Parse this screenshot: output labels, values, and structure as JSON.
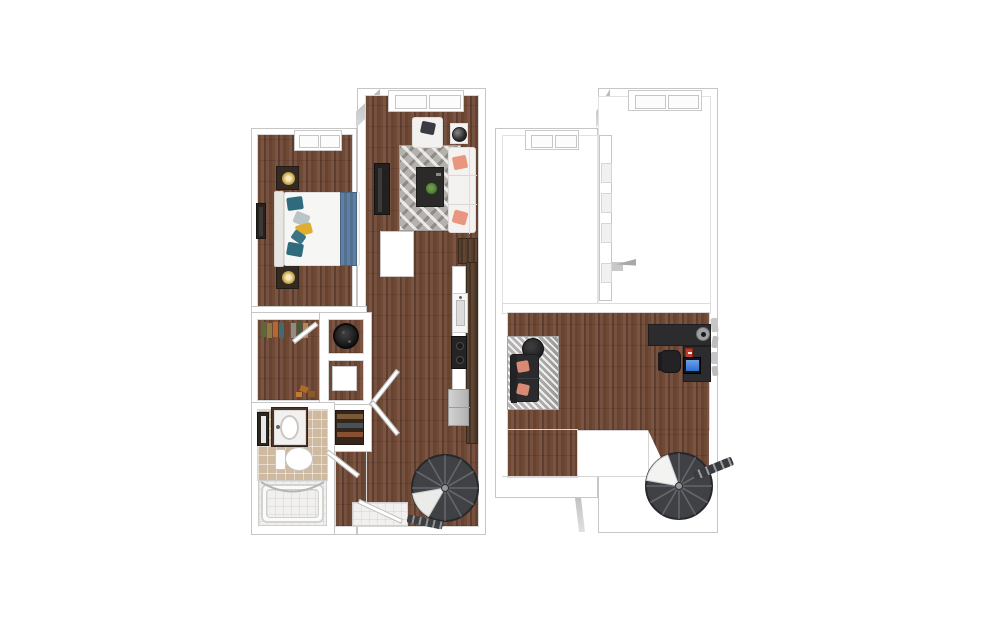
{
  "app": {
    "type": "3d-floor-plan-rendering",
    "background": "#ffffff",
    "levels_shown": 2
  },
  "palette": {
    "wall": "#ffffff",
    "wall_outline": "#c6c6c6",
    "step_shadow": "#b6b9bd",
    "wood_dark": "#5d3d2e",
    "wood_mid": "#6e4936",
    "wood_light": "#7c5441",
    "counter_wood": "#4f3a2a",
    "tile_tan": "#cdbaa1",
    "tile_white": "#f1f0ee",
    "rug_chevron": "#b5b1ac",
    "rug_loft": "#c7c5c3",
    "stair_dark": "#3f4145",
    "sofa_white": "#f3f2f0",
    "sofa_dark": "#2b2b2d",
    "pillow_coral": "#e8967f",
    "pillow_salmon": "#d98a74",
    "pillow_teal": "#2f6b7d",
    "pillow_yellow": "#dfae2e",
    "pillow_gray": "#b9c4c6",
    "bed_runner_blue": "#5e80a6",
    "plant_green": "#55803a",
    "monitor_screen_blue": "#2f6fd0",
    "appliance_black": "#1c1c1c",
    "fridge_gray": "#c6c6c6",
    "red_accent": "#c23b28"
  },
  "floors": [
    {
      "id": "floor-1",
      "label": "first-floor-plan",
      "rooms": [
        "bedroom",
        "living-room",
        "kitchen",
        "bathroom",
        "walk-in-closet",
        "laundry-closet",
        "linen-closet",
        "hallway",
        "entry"
      ],
      "furniture": [
        "bed",
        "headboard",
        "nightstand-upper",
        "nightstand-lower",
        "table-lamps",
        "wall-tv-bedroom",
        "bedroom-window",
        "armchair",
        "side-table",
        "sphere-lamp",
        "sofa",
        "coffee-table",
        "plant",
        "chevron-area-rug",
        "tv-console",
        "living-window",
        "kitchen-counter",
        "kitchen-sink",
        "stove",
        "refrigerator",
        "washer-dryer",
        "storage-shelves",
        "vanity-sink",
        "mirror",
        "toilet",
        "bathtub",
        "shower-curtain-rod",
        "spiral-staircase",
        "entry-door",
        "entry-mat",
        "interior-doors"
      ]
    },
    {
      "id": "floor-2",
      "label": "second-floor-plan",
      "rooms": [
        "loft",
        "open-to-below"
      ],
      "furniture": [
        "loveseat",
        "round-ottoman",
        "loft-area-rug",
        "l-shaped-desk",
        "desk-lamp",
        "monitor",
        "office-chair",
        "red-books",
        "wall-rack",
        "railing-wall",
        "spiral-staircase",
        "upper-window-left",
        "upper-window-right"
      ]
    }
  ]
}
